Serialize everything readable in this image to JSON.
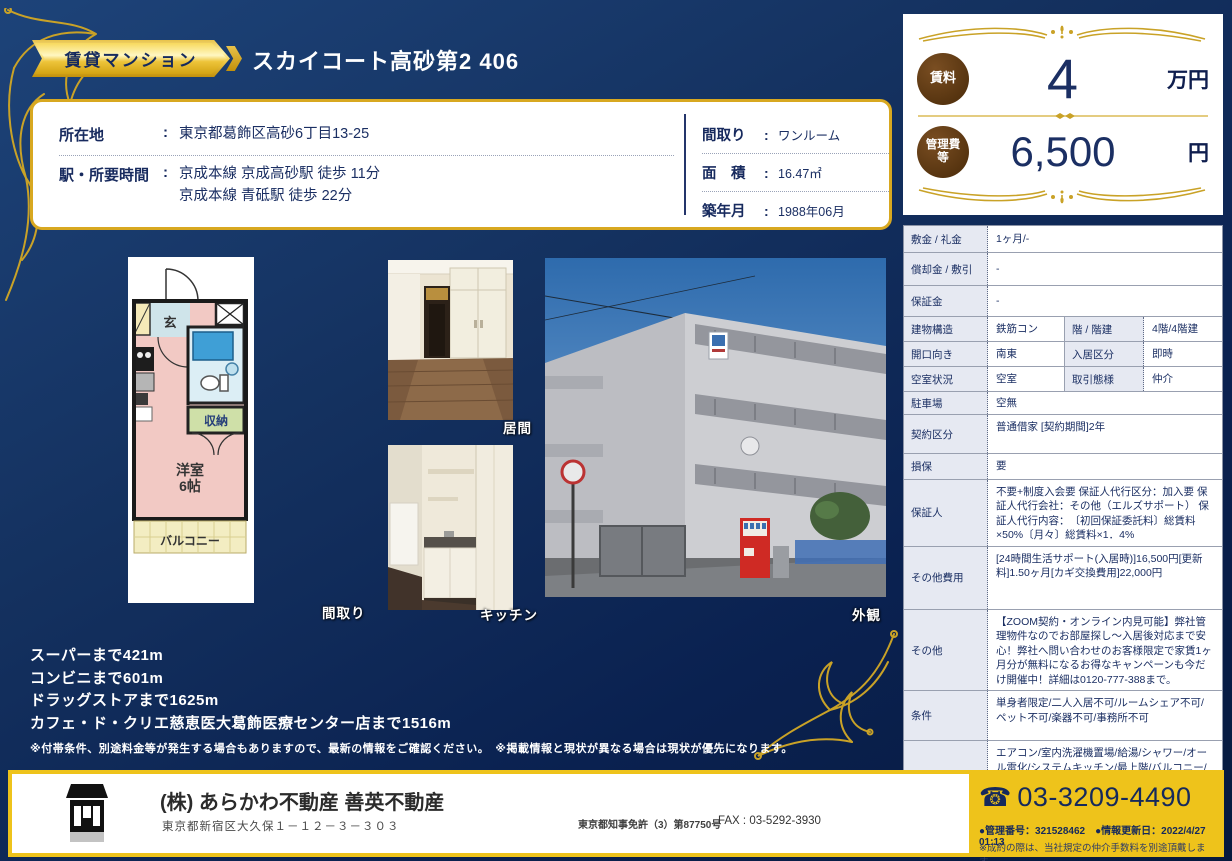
{
  "colors": {
    "navy": "#13295c",
    "gold": "#d8a820",
    "footer_yellow": "#eec31b",
    "circle_brown": "#55330f"
  },
  "header": {
    "badge": "賃貸マンション",
    "title": "スカイコート高砂第2 406"
  },
  "info_box": {
    "colon": ":",
    "location_label": "所在地",
    "location_value": "東京都葛飾区高砂6丁目13-25",
    "station_label": "駅・所要時間",
    "station_line1": "京成本線 京成高砂駅 徒歩 11分",
    "station_line2": "京成本線 青砥駅 徒歩 22分",
    "layout_label": "間取り",
    "layout_value": "ワンルーム",
    "area_label": "面　積",
    "area_value": "16.47㎡",
    "built_label": "築年月",
    "built_value": "1988年06月"
  },
  "photos": {
    "floorplan_label": "間取り",
    "living_label": "居間",
    "kitchen_label": "キッチン",
    "exterior_label": "外観"
  },
  "floorplan": {
    "entrance": "玄",
    "storage": "収納",
    "room_line1": "洋室",
    "room_line2": "6帖",
    "balcony": "バルコニー"
  },
  "distances": [
    "スーパーまで421m",
    "コンビニまで601m",
    "ドラッグストアまで1625m",
    "カフェ・ド・クリエ慈恵医大葛飾医療センター店まで1516m"
  ],
  "disclaimer": "※付帯条件、別途料金等が発生する場合もありますので、最新の情報をご確認ください。　※掲載情報と現状が異なる場合は現状が優先になります。",
  "price_panel": {
    "rent_label": "賃料",
    "rent_value": "4",
    "rent_unit": "万円",
    "fee_label": "管理費等",
    "fee_value": "6,500",
    "fee_unit": "円"
  },
  "spec_table": {
    "rows_a": [
      {
        "label": "敷金 / 礼金",
        "value": "1ヶ月/-"
      },
      {
        "label": "償却金 / 敷引",
        "value": "-"
      },
      {
        "label": "保証金",
        "value": "-"
      }
    ],
    "rows_q": [
      {
        "label1": "建物構造",
        "value1": "鉄筋コン",
        "label2": "階 / 階建",
        "value2": "4階/4階建"
      },
      {
        "label1": "開口向き",
        "value1": "南東",
        "label2": "入居区分",
        "value2": "即時"
      },
      {
        "label1": "空室状況",
        "value1": "空室",
        "label2": "取引態様",
        "value2": "仲介"
      }
    ],
    "rows_b": [
      {
        "label": "駐車場",
        "value": "空無"
      },
      {
        "label": "契約区分",
        "value": "普通借家 [契約期間]2年"
      },
      {
        "label": "損保",
        "value": "要"
      },
      {
        "label": "保証人",
        "value": "不要+制度入会要 保証人代行区分：加入要 保証人代行会社：その他（エルズサポート） 保証人代行内容：　〔初回保証委託料〕総賃料×50%〔月々〕総賃料×1．4%"
      },
      {
        "label": "その他費用",
        "value": "[24時間生活サポート(入居時)]16,500円[更新料]1.50ヶ月[カギ交換費用]22,000円"
      },
      {
        "label": "その他",
        "value": "【ZOOM契約・オンライン内見可能】弊社管理物件なのでお部屋探し～入居後対応まで安心！弊社へ問い合わせのお客様限定で家賃1ヶ月分が無料になるお得なキャンペーンも今だけ開催中！詳細は0120-777-388まで。"
      },
      {
        "label": "条件",
        "value": "単身者限定/二人入居不可/ルームシェア不可/ペット不可/楽器不可/事務所不可"
      },
      {
        "label": "設備",
        "value": "エアコン/室内洗濯機置場/給湯/シャワー/オール電化/システムキッチン/最上階/バルコニー/駐輪場あり/インターネット接続可/インターネット(あり)/分譲賃貸/外壁タイル/管理人(巡回)/24時間ゴミ出し可/IHコンロ"
      }
    ]
  },
  "footer": {
    "company": "(株) あらかわ不動産 善英不動産",
    "address": "東京都新宿区大久保１－１２－３－３０３",
    "license": "東京都知事免許（3）第87750号",
    "fax": "FAX : 03-5292-3930",
    "phone_icon": "☎",
    "phone": "03-3209-4490",
    "management": "●管理番号：321528462　●情報更新日：2022/4/27 01:13",
    "note": "※成約の際は、当社規定の仲介手数料を別途頂戴します。"
  }
}
